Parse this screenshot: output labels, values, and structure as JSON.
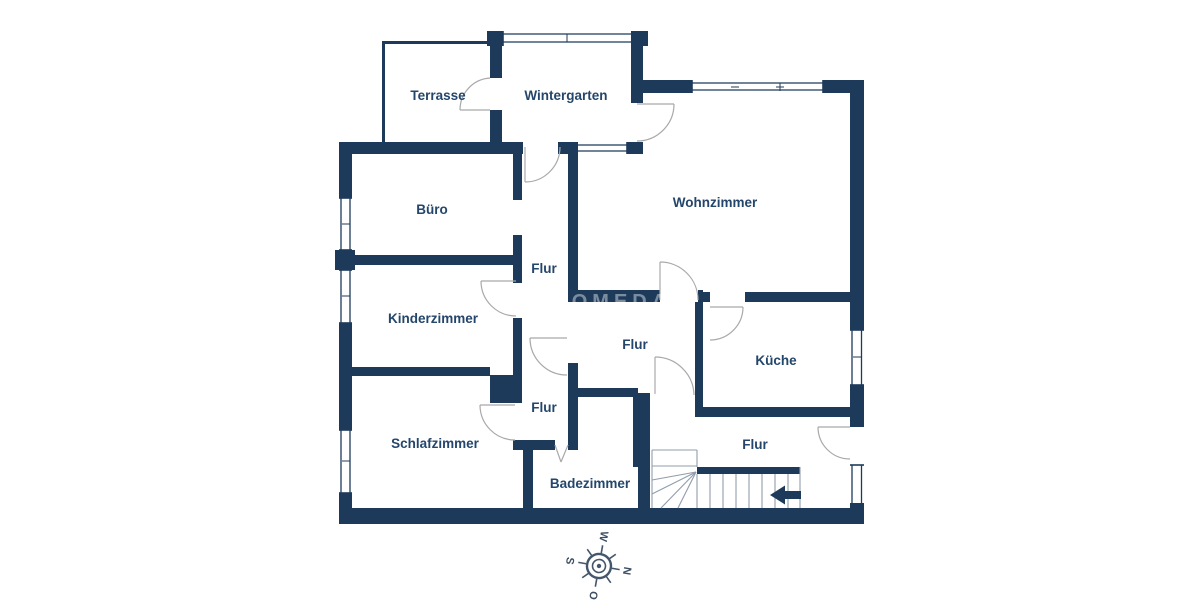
{
  "rooms": [
    {
      "id": "terrasse",
      "label": "Terrasse"
    },
    {
      "id": "wintergarten",
      "label": "Wintergarten"
    },
    {
      "id": "buero",
      "label": "Büro"
    },
    {
      "id": "wohnzimmer",
      "label": "Wohnzimmer"
    },
    {
      "id": "flur-upper",
      "label": "Flur"
    },
    {
      "id": "kinderzimmer",
      "label": "Kinderzimmer"
    },
    {
      "id": "flur-middle",
      "label": "Flur"
    },
    {
      "id": "kueche",
      "label": "Küche"
    },
    {
      "id": "flur-small",
      "label": "Flur"
    },
    {
      "id": "schlafzimmer",
      "label": "Schlafzimmer"
    },
    {
      "id": "badezimmer",
      "label": "Badezimmer"
    },
    {
      "id": "flur-stairs",
      "label": "Flur"
    }
  ],
  "compass": {
    "north": "N",
    "east": "O",
    "south": "S",
    "west": "W"
  },
  "watermark": "HOMEDAY",
  "colors": {
    "wall": "#1d3a5b",
    "label_text": "#24466b",
    "door_arc": "#a9a9a9",
    "stair_line": "#8f9dab",
    "background": "#ffffff"
  }
}
